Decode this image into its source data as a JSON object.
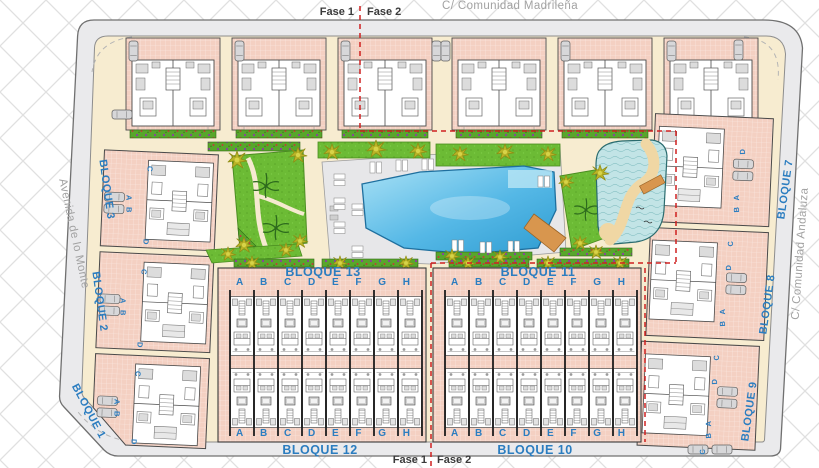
{
  "streets": {
    "top": "C/ Comunidad Madrileña",
    "left": "Avenida de lo Monte",
    "right": "C/ Comunidad Andaluza"
  },
  "phases": {
    "fase1": "Fase 1",
    "fase2": "Fase 2"
  },
  "blocks": {
    "left": [
      "BLOQUE 3",
      "BLOQUE 2",
      "BLOQUE 1"
    ],
    "right": [
      "BLOQUE 7",
      "BLOQUE 8",
      "BLOQUE 9"
    ],
    "center_top": [
      "BLOQUE 13",
      "BLOQUE 11"
    ],
    "center_bottom": [
      "BLOQUE 12",
      "BLOQUE 10"
    ],
    "unit_letters": [
      "A",
      "B",
      "C",
      "D",
      "E",
      "F",
      "G",
      "H"
    ],
    "side_unit_letters": [
      "A",
      "B",
      "C",
      "D"
    ]
  },
  "colors": {
    "phase_line": "#cf2020",
    "block_label": "#2b7dc0",
    "street_label": "#a2a2a2",
    "pool_water": "#4fb5e4",
    "grass": "#6cbb35",
    "building_fill": "#f4d0c2",
    "sand": "#f0d7a4"
  }
}
